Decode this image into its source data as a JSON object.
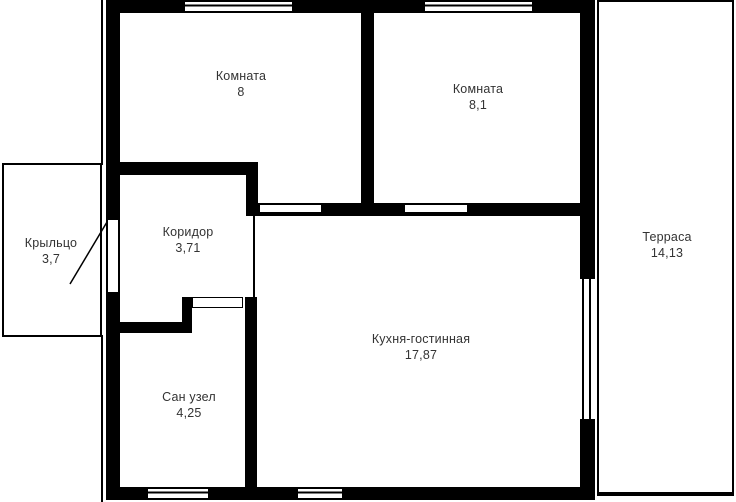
{
  "rooms": {
    "room1": {
      "name": "Комната",
      "area": "8"
    },
    "room2": {
      "name": "Комната",
      "area": "8,1"
    },
    "porch": {
      "name": "Крыльцо",
      "area": "3,7"
    },
    "corridor": {
      "name": "Коридор",
      "area": "3,71"
    },
    "kitchen": {
      "name": "Кухня-гостинная",
      "area": "17,87"
    },
    "bathroom": {
      "name": "Сан узел",
      "area": "4,25"
    },
    "terrace": {
      "name": "Терраса",
      "area": "14,13"
    }
  },
  "colors": {
    "wall": "#000000",
    "background": "#ffffff",
    "text": "#333333"
  }
}
